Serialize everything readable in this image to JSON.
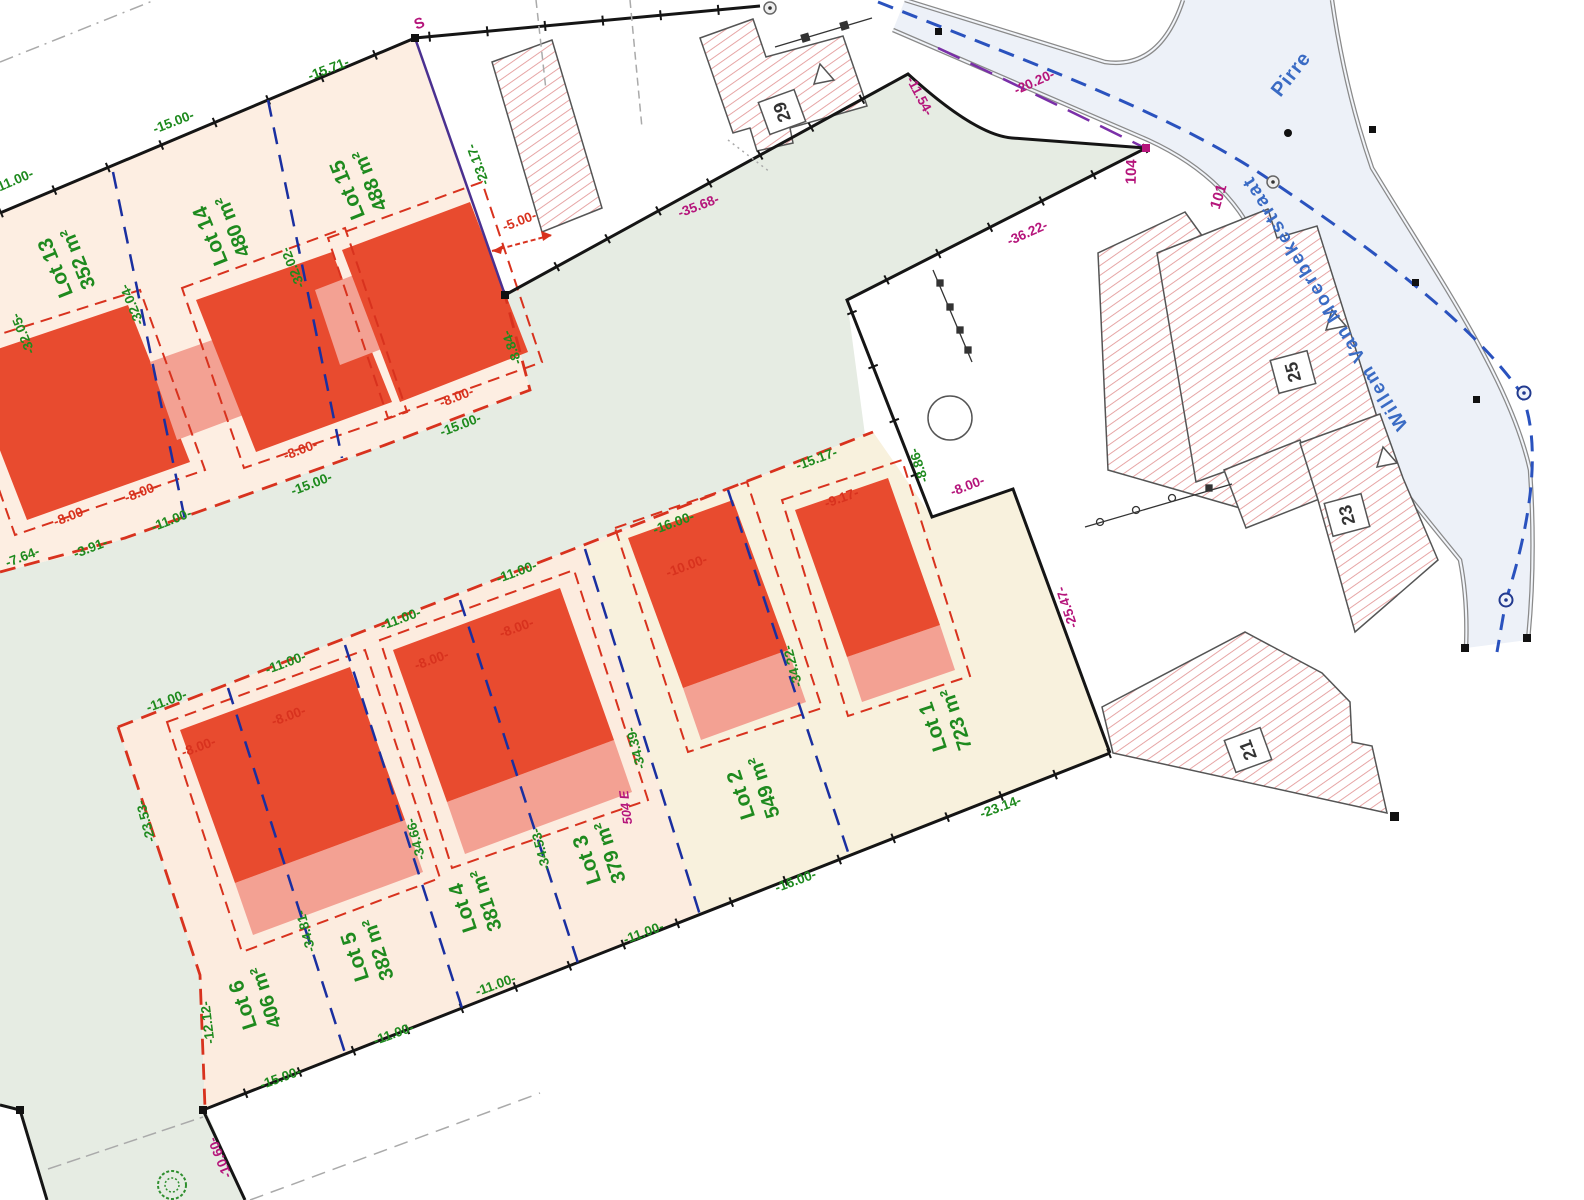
{
  "plan": {
    "lots": [
      {
        "name": "Lot 1",
        "area": "723 m²"
      },
      {
        "name": "Lot 2",
        "area": "549 m²"
      },
      {
        "name": "Lot 3",
        "area": "379 m²"
      },
      {
        "name": "Lot 4",
        "area": "381 m²"
      },
      {
        "name": "Lot 5",
        "area": "382 m²"
      },
      {
        "name": "Lot 6",
        "area": "406 m²"
      },
      {
        "name": "Lot 13",
        "area": "352 m²"
      },
      {
        "name": "Lot 14",
        "area": "480 m²"
      },
      {
        "name": "Lot 15",
        "area": "488 m²"
      }
    ],
    "streets": {
      "main": "Willem Van Moerbekestraat",
      "side": "Pirre"
    },
    "houses": [
      "29",
      "25",
      "23",
      "21"
    ],
    "refs": {
      "s": "S",
      "p104": "104",
      "p101": "101",
      "p504": "504 E"
    },
    "dims_green": [
      "-11.00-",
      "-15.00-",
      "-15.71-",
      "-32.05-",
      "-32.04-",
      "-32.02-",
      "-23.17-",
      "-8.84-",
      "-15.00-",
      "-15.00-",
      "-11.00-",
      "-3.91-",
      "-7.64-",
      "-11.00-",
      "-11.00-",
      "-11.00-",
      "-11.00-",
      "-16.00-",
      "-15.17-",
      "-23.53-",
      "-34.81-",
      "-34.66-",
      "-34.53-",
      "-34.39-",
      "-34.22-",
      "-12.12-",
      "-15.00-",
      "-11.00-",
      "-11.00-",
      "-11.00-",
      "-16.00-",
      "-23.14-",
      "-8.86-"
    ],
    "dims_red": [
      "-5.00-",
      "-8.00-",
      "-8.00-",
      "-8.00-",
      "-8.00-",
      "-8.00-",
      "-8.00-",
      "-8.00-",
      "-8.00-",
      "-10.00-",
      "-9.17-"
    ],
    "dims_magenta": [
      "-35.68-",
      "-11.54-",
      "-20.20-",
      "-36.22-",
      "-25.47-",
      "-8.00-",
      "-10.60-"
    ],
    "colors": {
      "building_red": "#e84b2f",
      "garage_pink": "#f3a193",
      "lot_cream": "#fcecdf",
      "lot_cream_east": "#f8f1dd",
      "grass_green": "#e6ece3",
      "road_fill": "#edf1f8",
      "hatch_red": "#e49c9c",
      "dim_green": "#1e8a1e",
      "dim_red": "#d8321e",
      "dim_magenta": "#b5157b",
      "boundary_blue": "#1a2fa0",
      "street_blue": "#3a6bc4"
    }
  }
}
